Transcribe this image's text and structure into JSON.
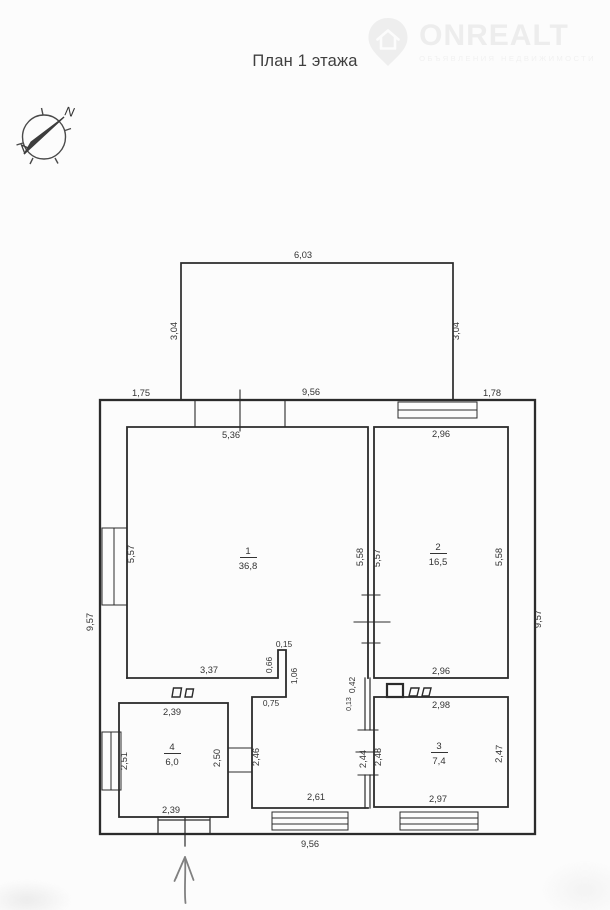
{
  "page": {
    "title": "План 1 этажа"
  },
  "watermark": {
    "brand": "ONREALT",
    "tagline": "ОБЪЯВЛЕНИЯ НЕДВИЖИМОСТИ"
  },
  "compass": {
    "north_label": "N"
  },
  "plan": {
    "rooms": [
      {
        "number": "1",
        "area": "36,8"
      },
      {
        "number": "2",
        "area": "16,5"
      },
      {
        "number": "3",
        "area": "7,4"
      },
      {
        "number": "4",
        "area": "6,0"
      }
    ],
    "dimensions": {
      "porch_width": "6,03",
      "porch_left": "3,04",
      "porch_right": "3,04",
      "top_left": "1,75",
      "top_center": "9,56",
      "top_right": "1,78",
      "room1_top": "5,36",
      "room2_top": "2,96",
      "left_wall": "9,57",
      "right_wall": "9,57",
      "room1_left": "5,57",
      "room1_right": "5,58",
      "room2_left": "5,57",
      "room2_right": "5,58",
      "room1_bottom": "3,37",
      "stub_width": "0,15",
      "stub_height": "0,66",
      "hall_entry": "1,06",
      "room2_bottom": "2,96",
      "wall_top": "0,42",
      "wall_bottom": "0,13",
      "hall_top": "0,75",
      "room3_top": "2,98",
      "room4_top": "2,39",
      "room4_left": "2,51",
      "room4_right": "2,50",
      "hall_left": "2,46",
      "hall_right": "2,44",
      "room3_left": "2,48",
      "room3_right": "2,47",
      "room4_bottom": "2,39",
      "hall_bottom": "2,61",
      "room3_bottom": "2,97",
      "bottom_wall": "9,56"
    }
  },
  "colors": {
    "wall": "#2b2b2b",
    "label": "#333333",
    "watermark": "#ededed"
  }
}
